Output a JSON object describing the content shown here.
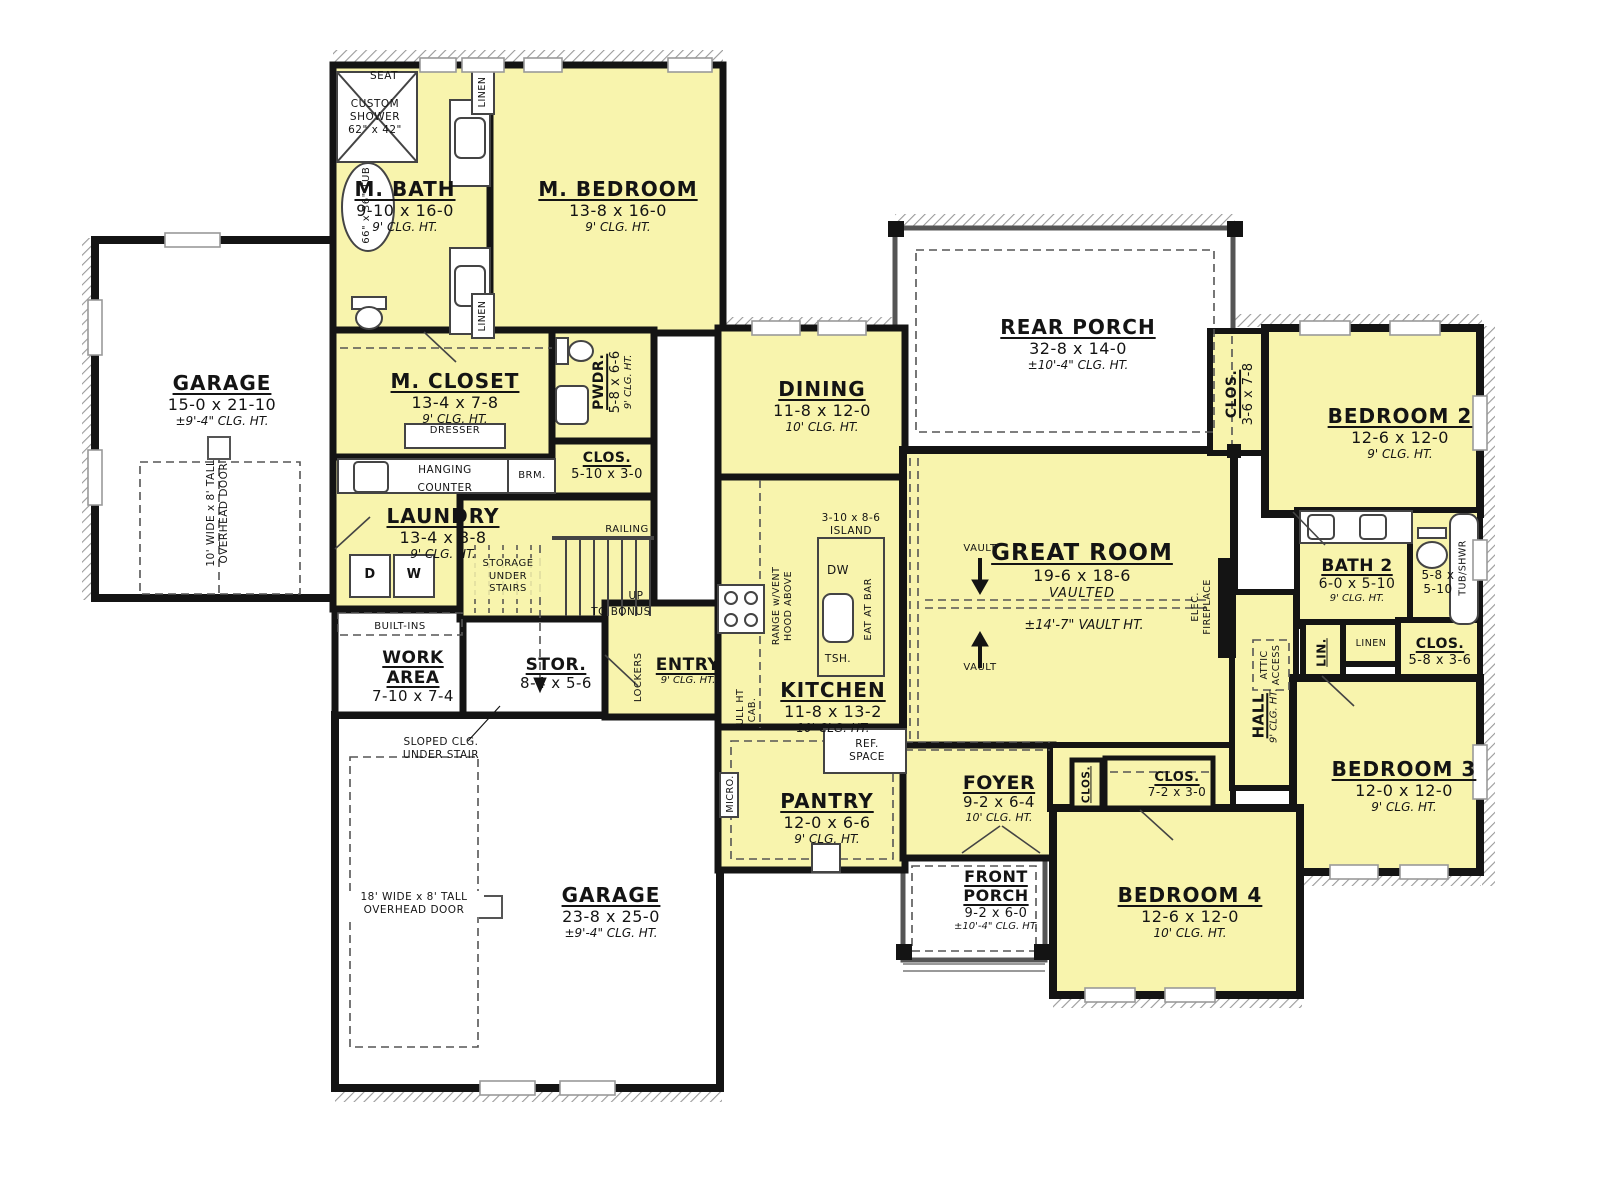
{
  "colors": {
    "room_fill": "#f8f4ad",
    "wall": "#141414",
    "porch_wall": "#555555",
    "hatch": "#9a9a9a"
  },
  "rooms": {
    "garage_left": {
      "name": "GARAGE",
      "dims": "15-0 x 21-10",
      "clg": "±9'-4\" CLG. HT."
    },
    "m_bath": {
      "name": "M. BATH",
      "dims": "9-10 x 16-0",
      "clg": "9' CLG. HT."
    },
    "m_bedroom": {
      "name": "M. BEDROOM",
      "dims": "13-8 x 16-0",
      "clg": "9' CLG. HT."
    },
    "m_closet": {
      "name": "M. CLOSET",
      "dims": "13-4 x 7-8",
      "clg": "9' CLG. HT."
    },
    "pwdr": {
      "name": "PWDR.",
      "dims": "5-8 x 6-6",
      "clg": "9' CLG. HT."
    },
    "clos_mud": {
      "name": "CLOS.",
      "dims": "5-10 x 3-0"
    },
    "laundry": {
      "name": "LAUNDRY",
      "dims": "13-4 x 8-8",
      "clg": "9' CLG. HT."
    },
    "work_area": {
      "name": "WORK AREA",
      "dims": "7-10 x 7-4"
    },
    "stor": {
      "name": "STOR.",
      "dims": "8-4 x 5-6"
    },
    "entry": {
      "name": "ENTRY",
      "clg": "9' CLG. HT."
    },
    "dining": {
      "name": "DINING",
      "dims": "11-8 x 12-0",
      "clg": "10' CLG. HT."
    },
    "kitchen": {
      "name": "KITCHEN",
      "dims": "11-8 x 13-2",
      "clg": "10' CLG. HT."
    },
    "pantry": {
      "name": "PANTRY",
      "dims": "12-0 x 6-6",
      "clg": "9' CLG. HT."
    },
    "rear_porch": {
      "name": "REAR PORCH",
      "dims": "32-8 x 14-0",
      "clg": "±10'-4\" CLG. HT."
    },
    "great_room": {
      "name": "GREAT ROOM",
      "dims": "19-6 x 18-6",
      "sub": "VAULTED",
      "vault_ht": "±14'-7\" VAULT HT."
    },
    "foyer": {
      "name": "FOYER",
      "dims": "9-2 x 6-4",
      "clg": "10' CLG. HT."
    },
    "front_porch": {
      "name": "FRONT PORCH",
      "dims": "9-2 x 6-0",
      "clg": "±10'-4\" CLG. HT."
    },
    "bedroom2": {
      "name": "BEDROOM 2",
      "dims": "12-6 x 12-0",
      "clg": "9' CLG. HT."
    },
    "clos_b2": {
      "name": "CLOS.",
      "dims": "3-6 x 7-8"
    },
    "bath2": {
      "name": "BATH 2",
      "dims": "6-0 x 5-10",
      "clg": "9' CLG. HT."
    },
    "wc": {
      "dims1": "5-8 x",
      "dims2": "5-10"
    },
    "clos_b3": {
      "name": "CLOS.",
      "dims": "5-8 x 3-6"
    },
    "bedroom3": {
      "name": "BEDROOM 3",
      "dims": "12-0 x 12-0",
      "clg": "9' CLG. HT."
    },
    "hall": {
      "name": "HALL",
      "clg": "9' CLG. HT."
    },
    "clos_foyer": {
      "name": "CLOS."
    },
    "clos_hall": {
      "name": "CLOS.",
      "dims": "7-2 x 3-0"
    },
    "bedroom4": {
      "name": "BEDROOM 4",
      "dims": "12-6 x 12-0",
      "clg": "10' CLG. HT."
    },
    "garage_main": {
      "name": "GARAGE",
      "dims": "23-8 x 25-0",
      "clg": "±9'-4\" CLG. HT."
    }
  },
  "ann": {
    "seat": "SEAT",
    "custom_shower": [
      "CUSTOM",
      "SHOWER",
      "62\" x 42\""
    ],
    "tub": "66\" x 36\" TUB",
    "linen": "LINEN",
    "dresser": "DRESSER",
    "hanging": "HANGING",
    "counter": "COUNTER",
    "brm": "BRM.",
    "d": "D",
    "w": "W",
    "dw": "DW",
    "tsh": "TSH.",
    "storage_stairs": [
      "STORAGE",
      "UNDER",
      "STAIRS"
    ],
    "railing": "RAILING",
    "up": "UP",
    "to_bonus": "TO BONUS",
    "built_ins": "BUILT-INS",
    "sloped": [
      "SLOPED CLG.",
      "UNDER STAIR"
    ],
    "lockers": "LOCKERS",
    "full_cab": [
      "FULL HT",
      "CAB."
    ],
    "range_hood": [
      "RANGE w/VENT",
      "HOOD ABOVE"
    ],
    "island": [
      "3-10 x 8-6",
      "ISLAND"
    ],
    "eat_bar": "EAT AT BAR",
    "ref_space": [
      "REF.",
      "SPACE"
    ],
    "micro": "MICRO.",
    "vault": "VAULT",
    "elec_fp": [
      "ELEC.",
      "FIREPLACE"
    ],
    "attic": [
      "ATTIC",
      "ACCESS"
    ],
    "lin": "LIN.",
    "tub_shwr": "TUB/SHWR",
    "ohd1": [
      "10' WIDE x 8' TALL",
      "OVERHEAD DOOR"
    ],
    "ohd2": [
      "18' WIDE x 8' TALL",
      "OVERHEAD DOOR"
    ]
  }
}
